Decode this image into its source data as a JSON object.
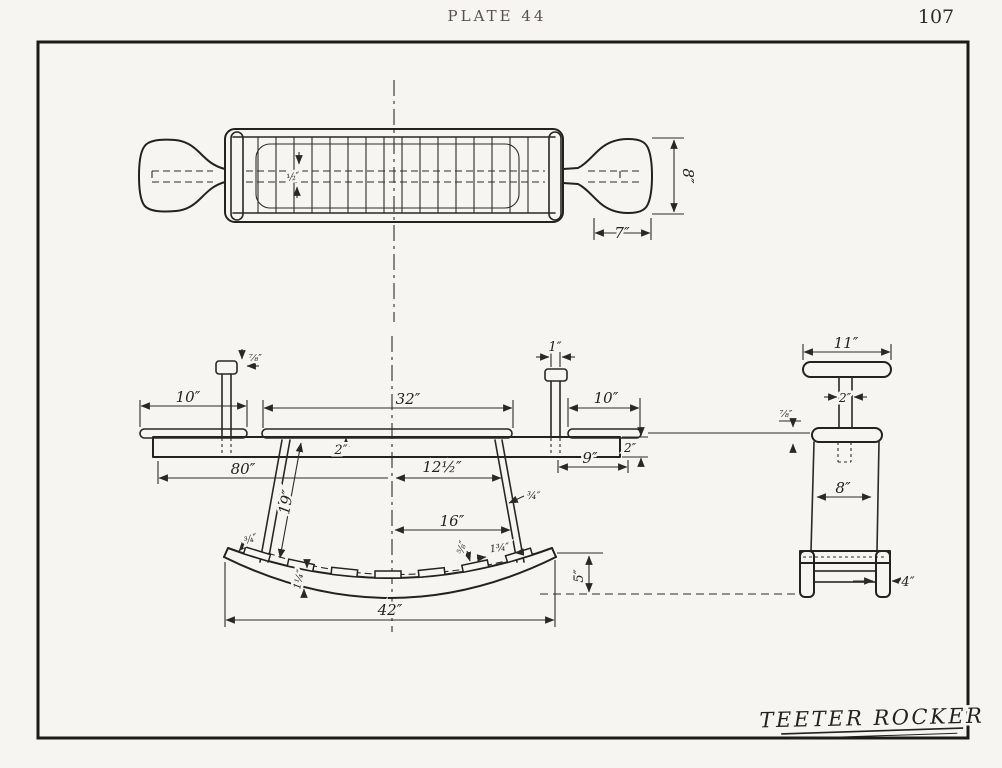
{
  "page": {
    "plate_label": "PLATE 44",
    "page_number": "107",
    "drawing_title": "TEETER ROCKER",
    "colors": {
      "paper": "#f6f5f1",
      "ink": "#24221e"
    }
  },
  "dimensions": {
    "plan": {
      "seat_width": "8″",
      "seat_length": "7″",
      "slat_gap": "½″"
    },
    "elevation": {
      "left_overhang": "10″",
      "center_span": "32″",
      "right_overhang": "10″",
      "left_handle_cap": "⅞″",
      "right_handle_width": "1″",
      "board_thickness_center": "2″",
      "board_thickness_end": "2″",
      "right_pad_length": "9″",
      "board_length": "80″",
      "center_to_strut": "12½″",
      "strut_length": "19″",
      "strut_thickness": "¾″",
      "center_to_strut_bottom": "16″",
      "cleat_thickness": "⅝″",
      "cleat_width": "1¾″",
      "rocker_tip": "¾″",
      "rocker_thickness": "1¼″",
      "rocker_span": "42″",
      "rocker_rise": "5″"
    },
    "end_view": {
      "handlebar_length": "11″",
      "handle_post_width": "2″",
      "board_thickness": "⅞″",
      "seat_width": "8″",
      "rocker_leg_width": "4″"
    }
  }
}
